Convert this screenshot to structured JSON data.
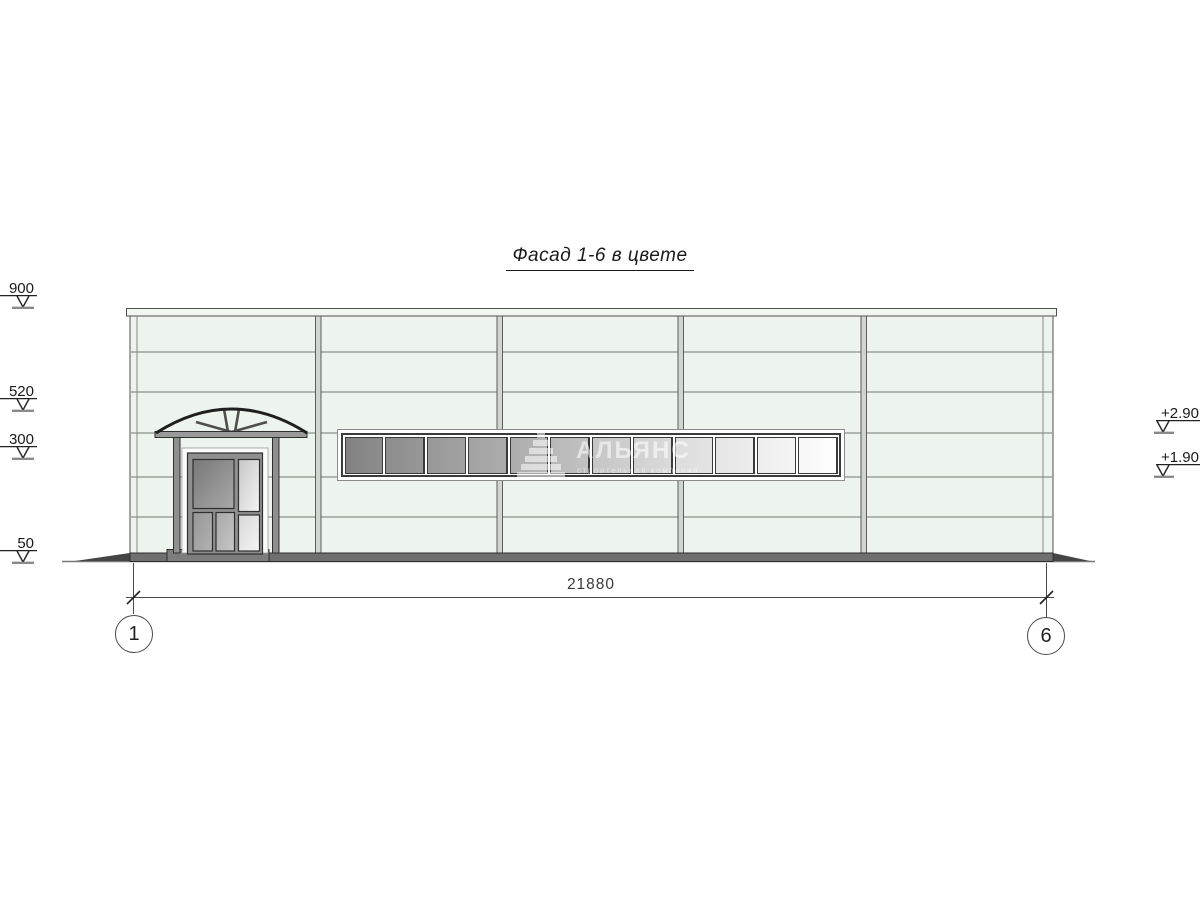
{
  "title": "Фасад 1-6 в цвете",
  "watermark": {
    "company": "АЛЬЯНС",
    "tagline": "строительная компания"
  },
  "dimension": {
    "overall_width": "21880"
  },
  "axis_markers": {
    "left": "1",
    "right": "6"
  },
  "elevation_markers": {
    "left": [
      {
        "label": "900"
      },
      {
        "label": "520"
      },
      {
        "label": "300"
      },
      {
        "label": "50"
      }
    ],
    "right": [
      {
        "label": "+2.90"
      },
      {
        "label": "+1.90"
      }
    ]
  },
  "window_strip": {
    "pane_count": 12,
    "glass_dark": "#828282",
    "glass_light": "#ffffff"
  },
  "colors": {
    "facade": "#edf3ed",
    "joint_line": "#6f786f",
    "plinth": "#6f6f6f",
    "frame_gray": "#8f8f8f",
    "outline": "#2f2f2f"
  }
}
